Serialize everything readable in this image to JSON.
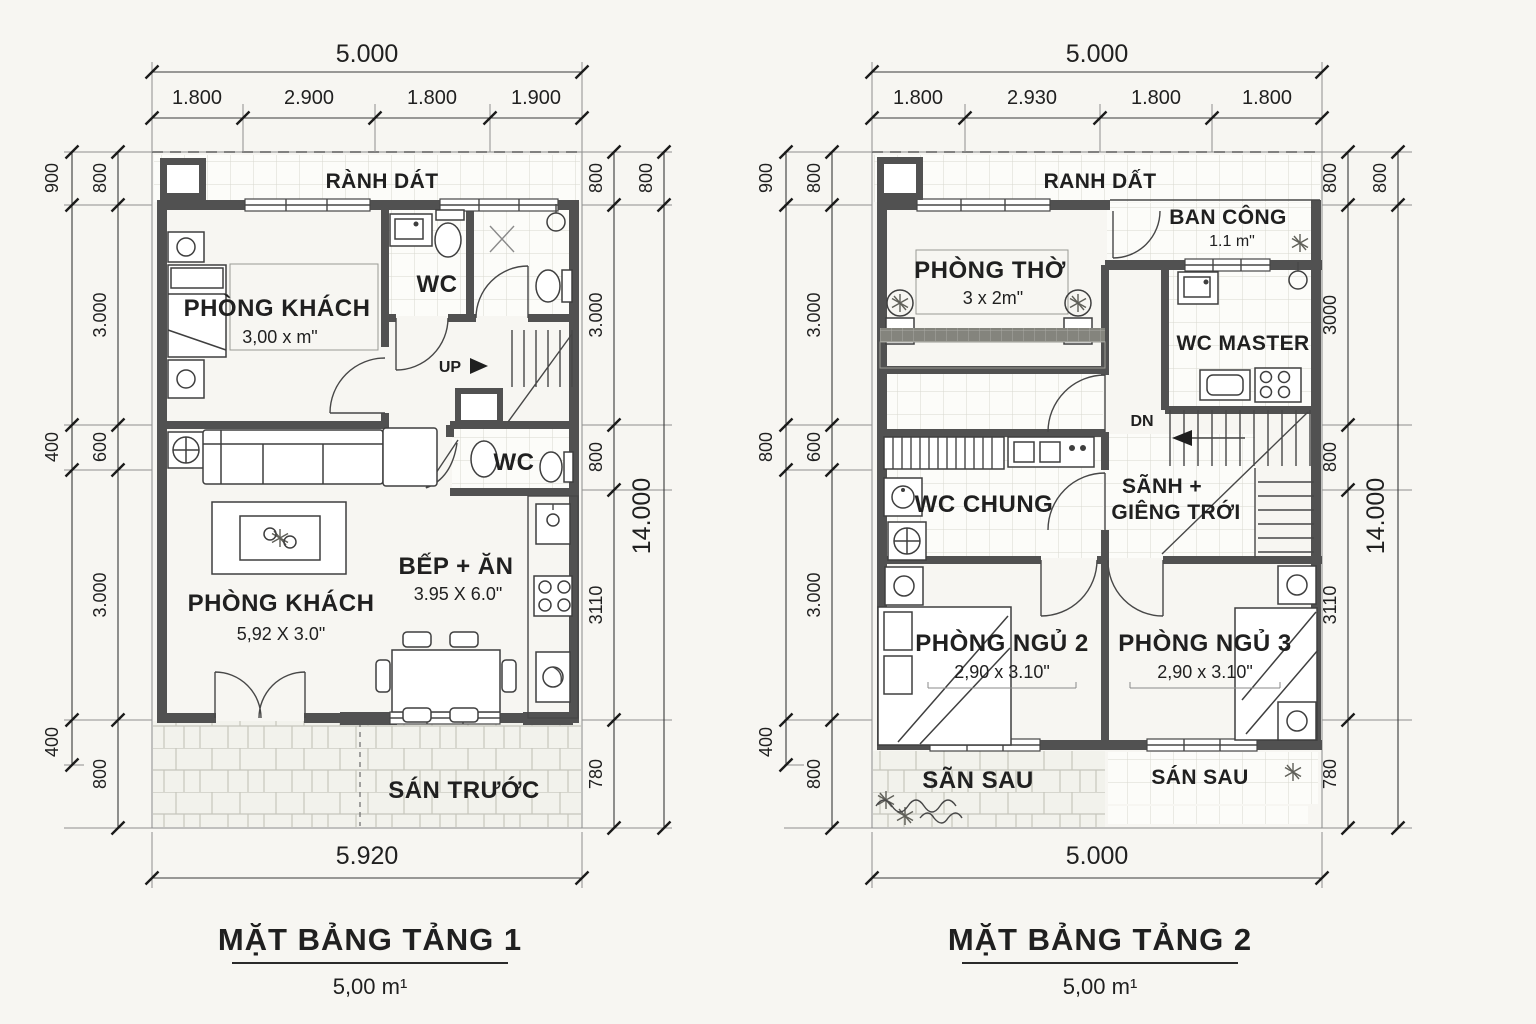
{
  "colors": {
    "wall": "#515151",
    "line": "#1b1b1b",
    "paper": "#f7f6f2"
  },
  "plan1": {
    "title": "MẶT BẢNG TẢNG 1",
    "area": "5,00 m¹",
    "dims": {
      "top_total": "5.000",
      "top_segments": [
        "1.800",
        "2.900",
        "1.800",
        "1.900"
      ],
      "bottom_total": "5.920",
      "left_outer": [
        "900",
        "400",
        "400"
      ],
      "left_inner": [
        "800",
        "3.000",
        "600",
        "3.000",
        "800"
      ],
      "right_inner": [
        "800",
        "3.000",
        "800",
        "3110",
        "780"
      ],
      "right_outer": [
        "800",
        "14.000"
      ]
    },
    "rooms": {
      "strip": "RÀNH DÁT",
      "bedroom": {
        "name": "PHÒNG KHÁCH",
        "size": "3,00 x m\""
      },
      "wc1": "WC",
      "wc2": "WC",
      "stairs": "UP",
      "living": {
        "name": "PHÒNG KHÁCH",
        "size": "5,92 X 3.0\""
      },
      "kitchen": {
        "name": "BẾP + ĂN",
        "size": "3.95 X 6.0\""
      },
      "yard": "SÁN TRƯỚC"
    }
  },
  "plan2": {
    "title": "MẶT BẢNG TẢNG 2",
    "area": "5,00 m¹",
    "dims": {
      "top_total": "5.000",
      "top_segments": [
        "1.800",
        "2.930",
        "1.800",
        "1.800"
      ],
      "bottom_total": "5.000",
      "left_outer": [
        "900",
        "800",
        "400"
      ],
      "left_inner": [
        "800",
        "3.000",
        "600",
        "3.000",
        "800"
      ],
      "right_inner": [
        "800",
        "3000",
        "800",
        "3110",
        "780"
      ],
      "right_outer": [
        "800",
        "14.000"
      ]
    },
    "rooms": {
      "strip": "RANH DẤT",
      "balcony": {
        "name": "BAN CÔNG",
        "size": "1.1 m\""
      },
      "altar": {
        "name": "PHÒNG THỜ",
        "size": "3 x 2m\""
      },
      "wc_master": "WC MASTER",
      "stairs": "DN",
      "hall_line1": "SÃNH +",
      "hall_line2": "GIÊNG TRỚI",
      "wc_chung": "WC CHUNG",
      "bed2": {
        "name": "PHÒNG NGỦ 2",
        "size": "2,90 x 3.10\""
      },
      "bed3": {
        "name": "PHÒNG NGỦ 3",
        "size": "2,90 x 3.10\""
      },
      "yard_left": "SÃN SAU",
      "yard_right": "SÁN SAU"
    }
  }
}
